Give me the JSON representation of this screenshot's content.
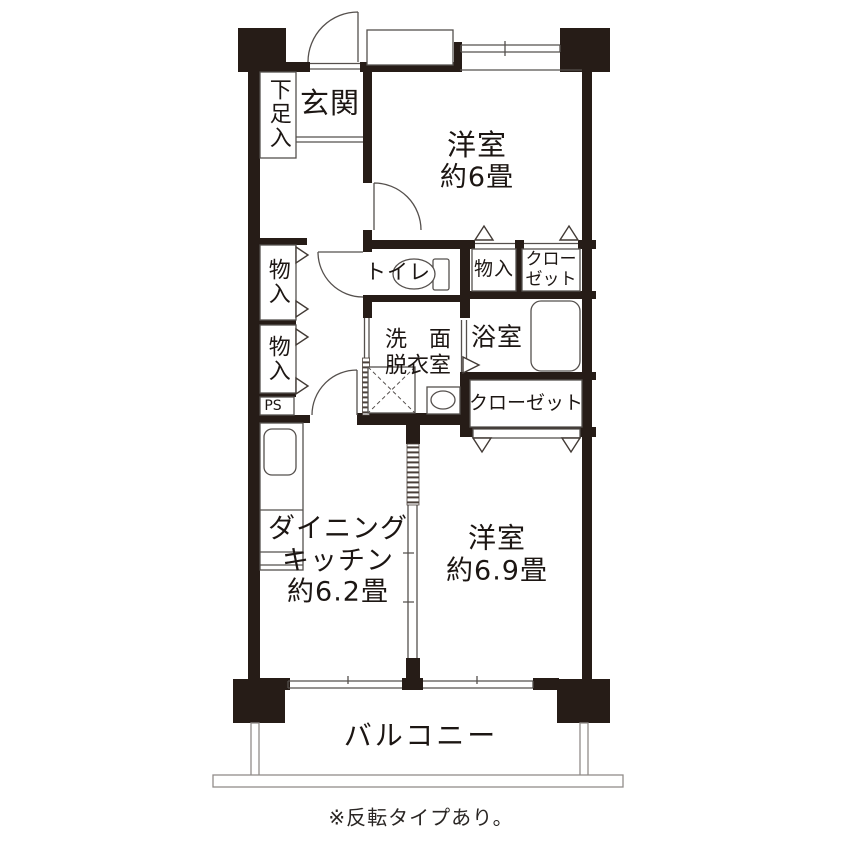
{
  "rooms": {
    "entrance": {
      "label": "玄関"
    },
    "shoe_box": {
      "label": "下足入"
    },
    "western_room_1": {
      "name": "洋室",
      "size": "約6畳"
    },
    "toilet": {
      "label": "トイレ"
    },
    "storage_upper_right": {
      "label": "物入"
    },
    "closet_upper_right": {
      "label": "クロー\nゼット"
    },
    "bathroom": {
      "label": "浴室"
    },
    "washroom": {
      "label": "洗　面\n脱衣室"
    },
    "storage_left_upper": {
      "label": "物入"
    },
    "storage_left_lower": {
      "label": "物入"
    },
    "pipe_space": {
      "label": "PS"
    },
    "closet_lower_right": {
      "label": "クローゼット"
    },
    "dining_kitchen": {
      "name": "ダイニング\nキッチン",
      "size": "約6.2畳"
    },
    "western_room_2": {
      "name": "洋室",
      "size": "約6.9畳"
    },
    "balcony": {
      "label": "バルコニー"
    }
  },
  "note": "※反転タイプあり。",
  "icons": {
    "toilet": "toilet-bowl-icon",
    "bathtub": "bathtub-icon",
    "kitchen_sink": "kitchen-sink-icon",
    "washbasin": "washbasin-icon",
    "washing_machine": "washing-machine-area-icon"
  },
  "colors": {
    "wall": "#261c17",
    "thin_line": "#55504d",
    "background": "#ffffff",
    "text": "#1c1613"
  }
}
